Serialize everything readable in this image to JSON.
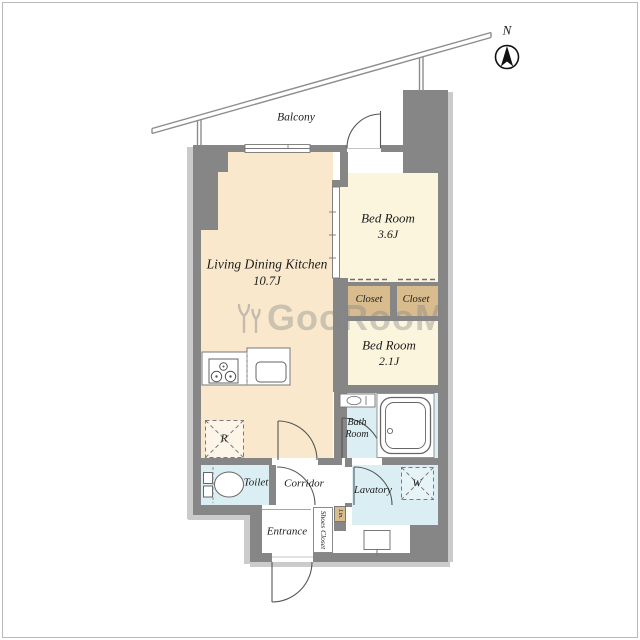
{
  "plan": {
    "compass_label": "N",
    "balcony_label": "Balcony",
    "watermark": "GooRooM",
    "rooms": {
      "ldk": {
        "name": "Living Dining Kitchen",
        "size": "10.7J"
      },
      "bedroom_a": {
        "name": "Bed Room",
        "size": "3.6J"
      },
      "bedroom_b": {
        "name": "Bed Room",
        "size": "2.1J"
      },
      "closet_a": "Closet",
      "closet_b": "Closet",
      "bath": {
        "line1": "Bath",
        "line2": "Room"
      },
      "lavatory": "Lavatory",
      "toilet": "Toilet",
      "corridor": "Corridor",
      "entrance": "Entrance",
      "shoes_closet": "Shoes Closet",
      "linen": "Lin.",
      "refrigerator_mark": "R",
      "washer_mark": "W"
    },
    "colors": {
      "wall": "#868686",
      "ldk_floor": "#f9e8cc",
      "bedroom_floor": "#fcf5de",
      "closet_floor": "#d8bc8e",
      "wet_area_floor": "#daeef3",
      "shadow": "#cbcbcb",
      "watermark": "#848484"
    }
  }
}
